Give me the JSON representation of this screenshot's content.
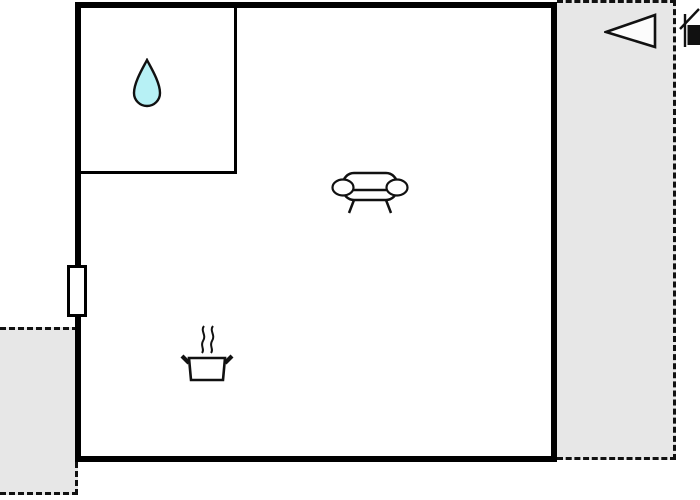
{
  "title": "floor-plan",
  "colors": {
    "background": "#ffffff",
    "wall": "#000000",
    "terrace_fill": "#e7e7e7",
    "dashed_outline": "#111111",
    "icon_stroke": "#111111",
    "icon_fill": "#ffffff",
    "water_drop_fill": "#b7f1f5",
    "triangle_fill": "#fcfcfc",
    "house_block_fill": "#111111"
  },
  "floorplan": {
    "rooms": [
      {
        "name": "main-room",
        "walls": "thick-solid"
      },
      {
        "name": "bathroom",
        "walls": "thin-solid",
        "icon": "water-drop-icon"
      }
    ],
    "areas": [
      {
        "name": "terrace-right",
        "outline": "dashed",
        "fill": "gray"
      },
      {
        "name": "terrace-bottom-left",
        "outline": "dashed",
        "fill": "gray"
      }
    ],
    "markers": [
      {
        "name": "water-drop-icon",
        "meaning": "bathroom / water"
      },
      {
        "name": "sofa-icon",
        "meaning": "living area"
      },
      {
        "name": "cooking-pot-icon",
        "meaning": "kitchen"
      },
      {
        "name": "window-marker",
        "meaning": "window on left wall"
      },
      {
        "name": "direction-triangle-icon",
        "meaning": "orientation arrow pointing left"
      },
      {
        "name": "house-icon",
        "meaning": "building reference, clipped at right edge"
      }
    ]
  }
}
